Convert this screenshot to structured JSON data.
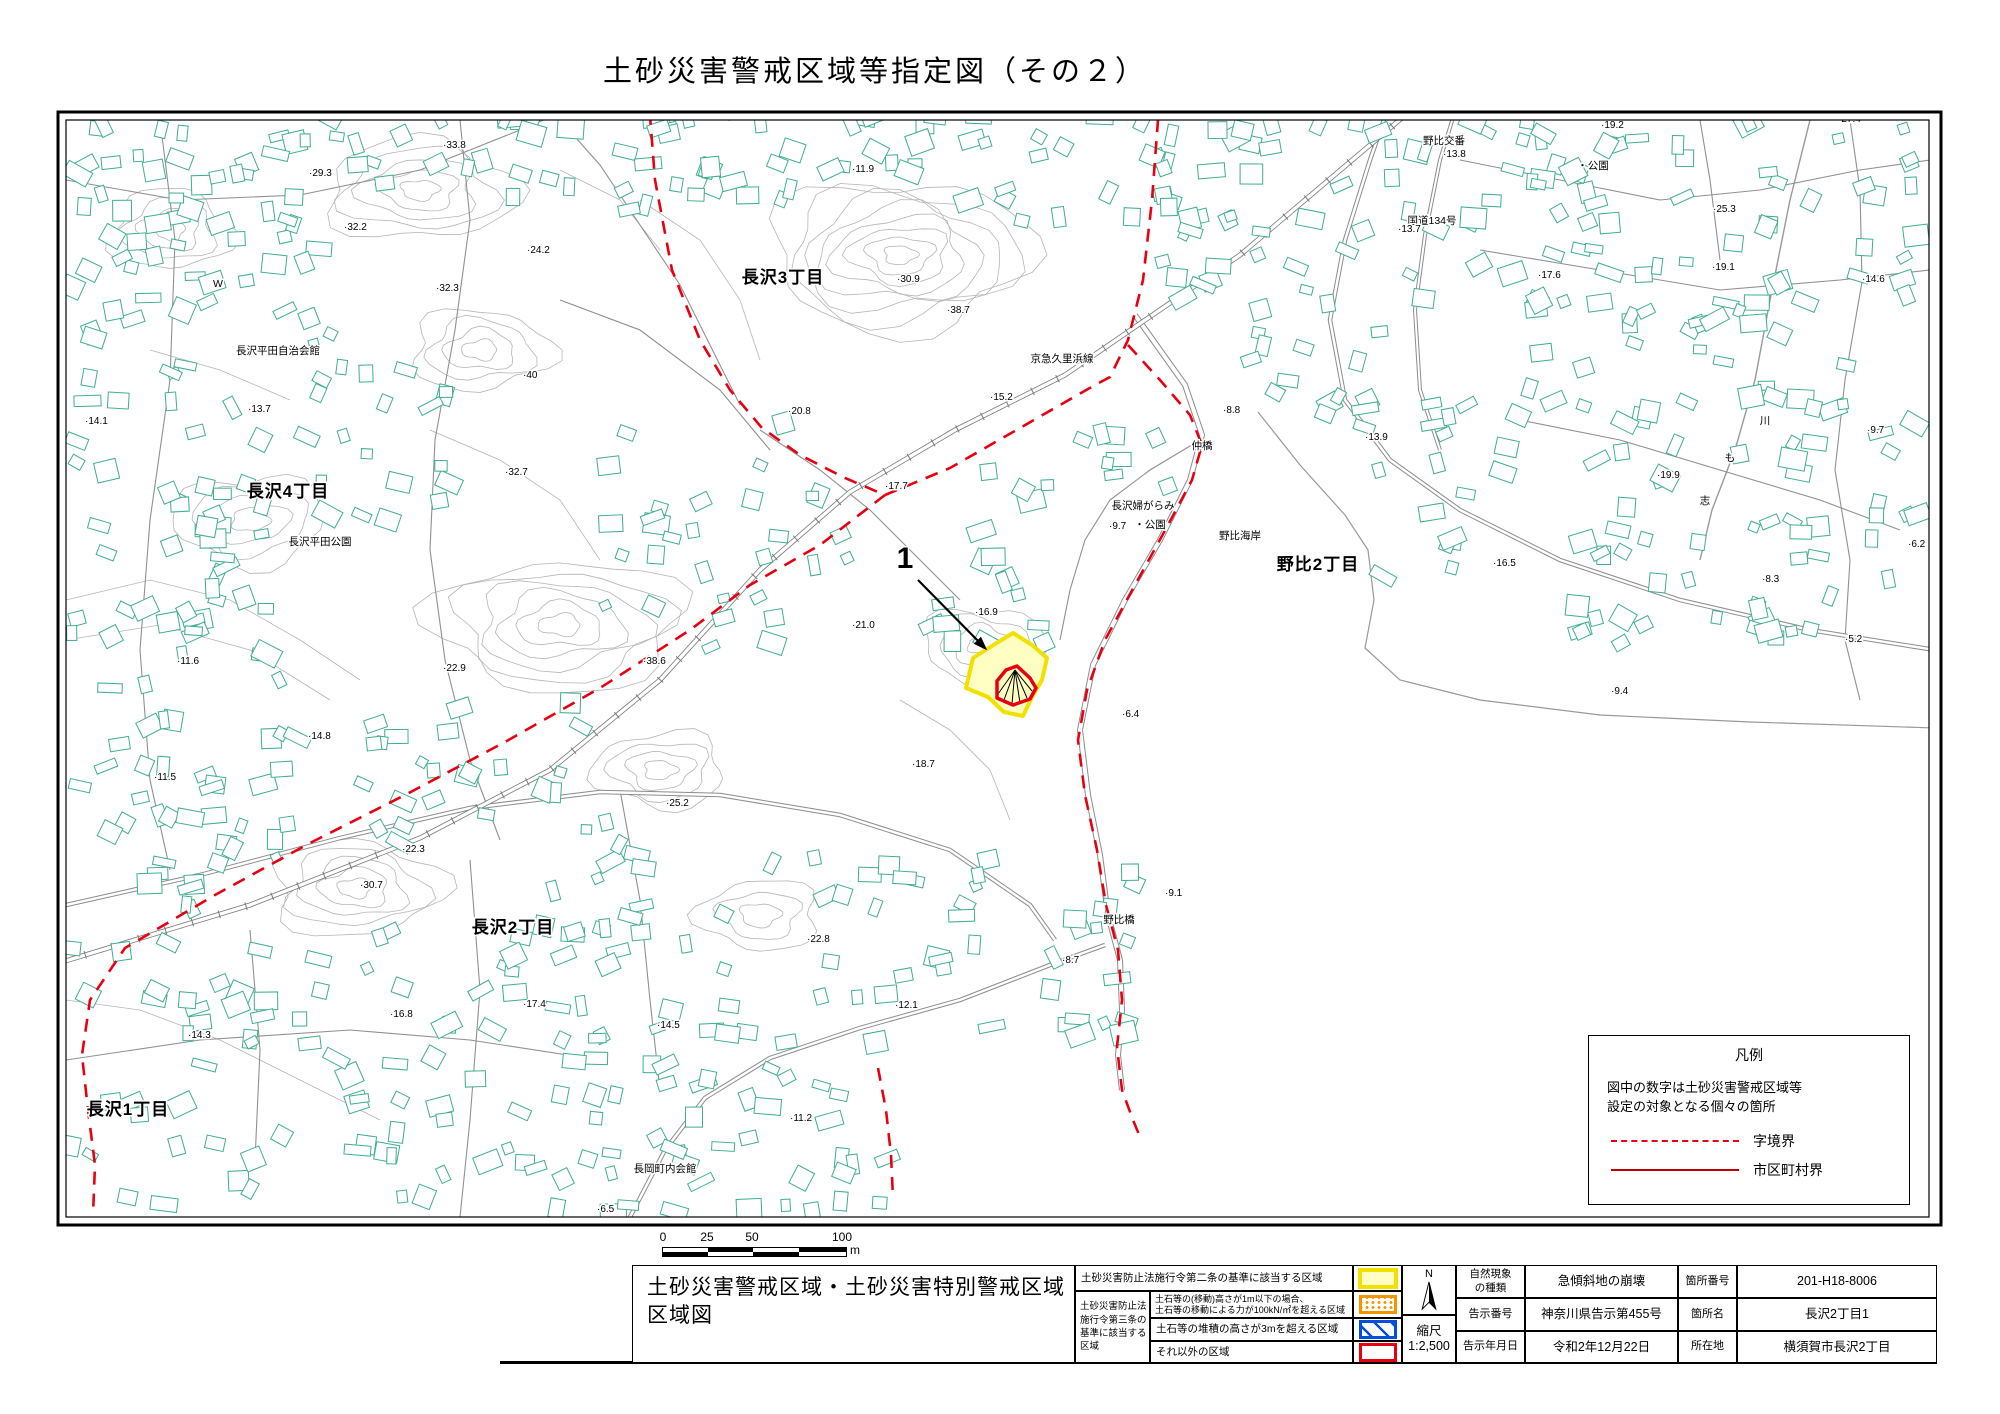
{
  "title": "土砂災害警戒区域等指定図（その２）",
  "colors": {
    "building_outline": "#3fae8f",
    "contour": "#b5b5b5",
    "road": "#8c8c8c",
    "rail": "#777777",
    "boundary_red": "#e60012",
    "zone_yellow_border": "#f2e000",
    "zone_yellow_fill": "#ffffc4",
    "zone_red_border": "#e60012"
  },
  "map": {
    "district_labels": [
      {
        "text": "長沢3丁目",
        "x": 783,
        "y": 283
      },
      {
        "text": "長沢4丁目",
        "x": 288,
        "y": 497
      },
      {
        "text": "野比2丁目",
        "x": 1318,
        "y": 570
      },
      {
        "text": "長沢2丁目",
        "x": 513,
        "y": 933
      },
      {
        "text": "長沢1丁目",
        "x": 128,
        "y": 1115
      }
    ],
    "place_labels": [
      {
        "text": "長沢平田自治会館",
        "x": 278,
        "y": 354
      },
      {
        "text": "長沢平田公園",
        "x": 320,
        "y": 545
      },
      {
        "text": "京急久里浜線",
        "x": 1062,
        "y": 362
      },
      {
        "text": "仲橋",
        "x": 1202,
        "y": 449
      },
      {
        "text": "野比海岸",
        "x": 1240,
        "y": 539
      },
      {
        "text": "長沢婦がらみ",
        "x": 1143,
        "y": 509
      },
      {
        "text": "・公園",
        "x": 1150,
        "y": 528
      },
      {
        "text": "野比交番",
        "x": 1444,
        "y": 144
      },
      {
        "text": "・公園",
        "x": 1593,
        "y": 169
      },
      {
        "text": "国道134号",
        "x": 1432,
        "y": 224
      },
      {
        "text": "長岡町内会館",
        "x": 665,
        "y": 1172
      },
      {
        "text": "野比橋",
        "x": 1119,
        "y": 923
      },
      {
        "text": "W",
        "x": 218,
        "y": 287
      },
      {
        "text": "川",
        "x": 1765,
        "y": 424
      },
      {
        "text": "も",
        "x": 1730,
        "y": 461
      },
      {
        "text": "志",
        "x": 1705,
        "y": 504
      }
    ],
    "spot_heights": [
      {
        "v": "21.1",
        "x": 787,
        "y": 117
      },
      {
        "v": "33.8",
        "x": 443,
        "y": 148
      },
      {
        "v": "29.3",
        "x": 309,
        "y": 176
      },
      {
        "v": "11.9",
        "x": 852,
        "y": 172
      },
      {
        "v": "32.2",
        "x": 344,
        "y": 230
      },
      {
        "v": "24.2",
        "x": 527,
        "y": 253
      },
      {
        "v": "30.9",
        "x": 897,
        "y": 282
      },
      {
        "v": "38.7",
        "x": 947,
        "y": 313
      },
      {
        "v": "32.3",
        "x": 436,
        "y": 291
      },
      {
        "v": "13.7",
        "x": 248,
        "y": 412
      },
      {
        "v": "14.1",
        "x": 85,
        "y": 424
      },
      {
        "v": "20.8",
        "x": 788,
        "y": 414
      },
      {
        "v": "15.2",
        "x": 990,
        "y": 400
      },
      {
        "v": "17.7",
        "x": 885,
        "y": 489
      },
      {
        "v": "32.7",
        "x": 505,
        "y": 475
      },
      {
        "v": "40",
        "x": 523,
        "y": 378
      },
      {
        "v": "11.6",
        "x": 177,
        "y": 664
      },
      {
        "v": "22.9",
        "x": 443,
        "y": 671
      },
      {
        "v": "38.6",
        "x": 643,
        "y": 664
      },
      {
        "v": "21.0",
        "x": 852,
        "y": 628
      },
      {
        "v": "16.9",
        "x": 975,
        "y": 615
      },
      {
        "v": "14.8",
        "x": 308,
        "y": 739
      },
      {
        "v": "11.5",
        "x": 154,
        "y": 780
      },
      {
        "v": "25.2",
        "x": 666,
        "y": 806
      },
      {
        "v": "18.7",
        "x": 912,
        "y": 767
      },
      {
        "v": "6.4",
        "x": 1122,
        "y": 717
      },
      {
        "v": "22.3",
        "x": 402,
        "y": 852
      },
      {
        "v": "30.7",
        "x": 360,
        "y": 888
      },
      {
        "v": "22.8",
        "x": 807,
        "y": 942
      },
      {
        "v": "9.1",
        "x": 1165,
        "y": 896
      },
      {
        "v": "8.7",
        "x": 1062,
        "y": 963
      },
      {
        "v": "16.8",
        "x": 390,
        "y": 1017
      },
      {
        "v": "17.4",
        "x": 523,
        "y": 1007
      },
      {
        "v": "14.5",
        "x": 657,
        "y": 1028
      },
      {
        "v": "12.1",
        "x": 895,
        "y": 1008
      },
      {
        "v": "14.3",
        "x": 188,
        "y": 1038
      },
      {
        "v": "11.2",
        "x": 790,
        "y": 1121
      },
      {
        "v": "6.5",
        "x": 597,
        "y": 1212
      },
      {
        "v": "13.8",
        "x": 1443,
        "y": 157
      },
      {
        "v": "19.2",
        "x": 1601,
        "y": 128
      },
      {
        "v": "27.4",
        "x": 1838,
        "y": 122
      },
      {
        "v": "25.3",
        "x": 1713,
        "y": 212
      },
      {
        "v": "13.7",
        "x": 1398,
        "y": 232
      },
      {
        "v": "14.6",
        "x": 1862,
        "y": 282
      },
      {
        "v": "17.6",
        "x": 1538,
        "y": 278
      },
      {
        "v": "19.1",
        "x": 1712,
        "y": 270
      },
      {
        "v": "13.9",
        "x": 1365,
        "y": 440
      },
      {
        "v": "8.8",
        "x": 1223,
        "y": 413
      },
      {
        "v": "9.7",
        "x": 1109,
        "y": 529
      },
      {
        "v": "9.7",
        "x": 1867,
        "y": 433
      },
      {
        "v": "19.9",
        "x": 1657,
        "y": 478
      },
      {
        "v": "16.5",
        "x": 1493,
        "y": 566
      },
      {
        "v": "8.3",
        "x": 1762,
        "y": 582
      },
      {
        "v": "6.2",
        "x": 1908,
        "y": 547
      },
      {
        "v": "5.2",
        "x": 1845,
        "y": 642
      },
      {
        "v": "9.4",
        "x": 1611,
        "y": 694
      }
    ],
    "site_marker": {
      "label": "1",
      "x": 905,
      "y": 568,
      "ax1": 918,
      "ay1": 580,
      "ax2": 983,
      "ay2": 646
    }
  },
  "legend_box": {
    "title": "凡例",
    "note_line1": "図中の数字は土砂災害警戒区域等",
    "note_line2": "設定の対象となる個々の箇所",
    "dashed_label": "字境界",
    "solid_label": "市区町村界"
  },
  "scale_bar": {
    "ticks": [
      "0",
      "25",
      "50",
      "100"
    ],
    "unit": "m"
  },
  "table": {
    "map_title_line1": "土砂災害警戒区域・土砂災害特別警戒区域",
    "map_title_line2": "区域図",
    "law2_text": "土砂災害防止法施行令第二条の基準に該当する区域",
    "law3_label_lines": [
      "土砂災害防止法",
      "施行令第三条の",
      "基準に該当する",
      "区域"
    ],
    "law3_row1_line1": "土石等の(移動)高さが1m以下の場合、",
    "law3_row1_line2": "土石等の移動による力が100kN/㎡を超える区域",
    "law3_row2": "土石等の堆積の高さが3mを超える区域",
    "law3_row3": "それ以外の区域",
    "north_label": "N",
    "scale_label": "縮尺",
    "scale_value": "1:2,500",
    "info": {
      "r1c1a": "自然現象",
      "r1c1b": "の種類",
      "r1v1": "急傾斜地の崩壊",
      "r1c2": "箇所番号",
      "r1v2": "201-H18-8006",
      "r2c1": "告示番号",
      "r2v1": "神奈川県告示第455号",
      "r2c2": "箇所名",
      "r2v2": "長沢2丁目1",
      "r3c1": "告示年月日",
      "r3v1": "令和2年12月22日",
      "r3c2": "所在地",
      "r3v2": "横須賀市長沢2丁目"
    }
  }
}
